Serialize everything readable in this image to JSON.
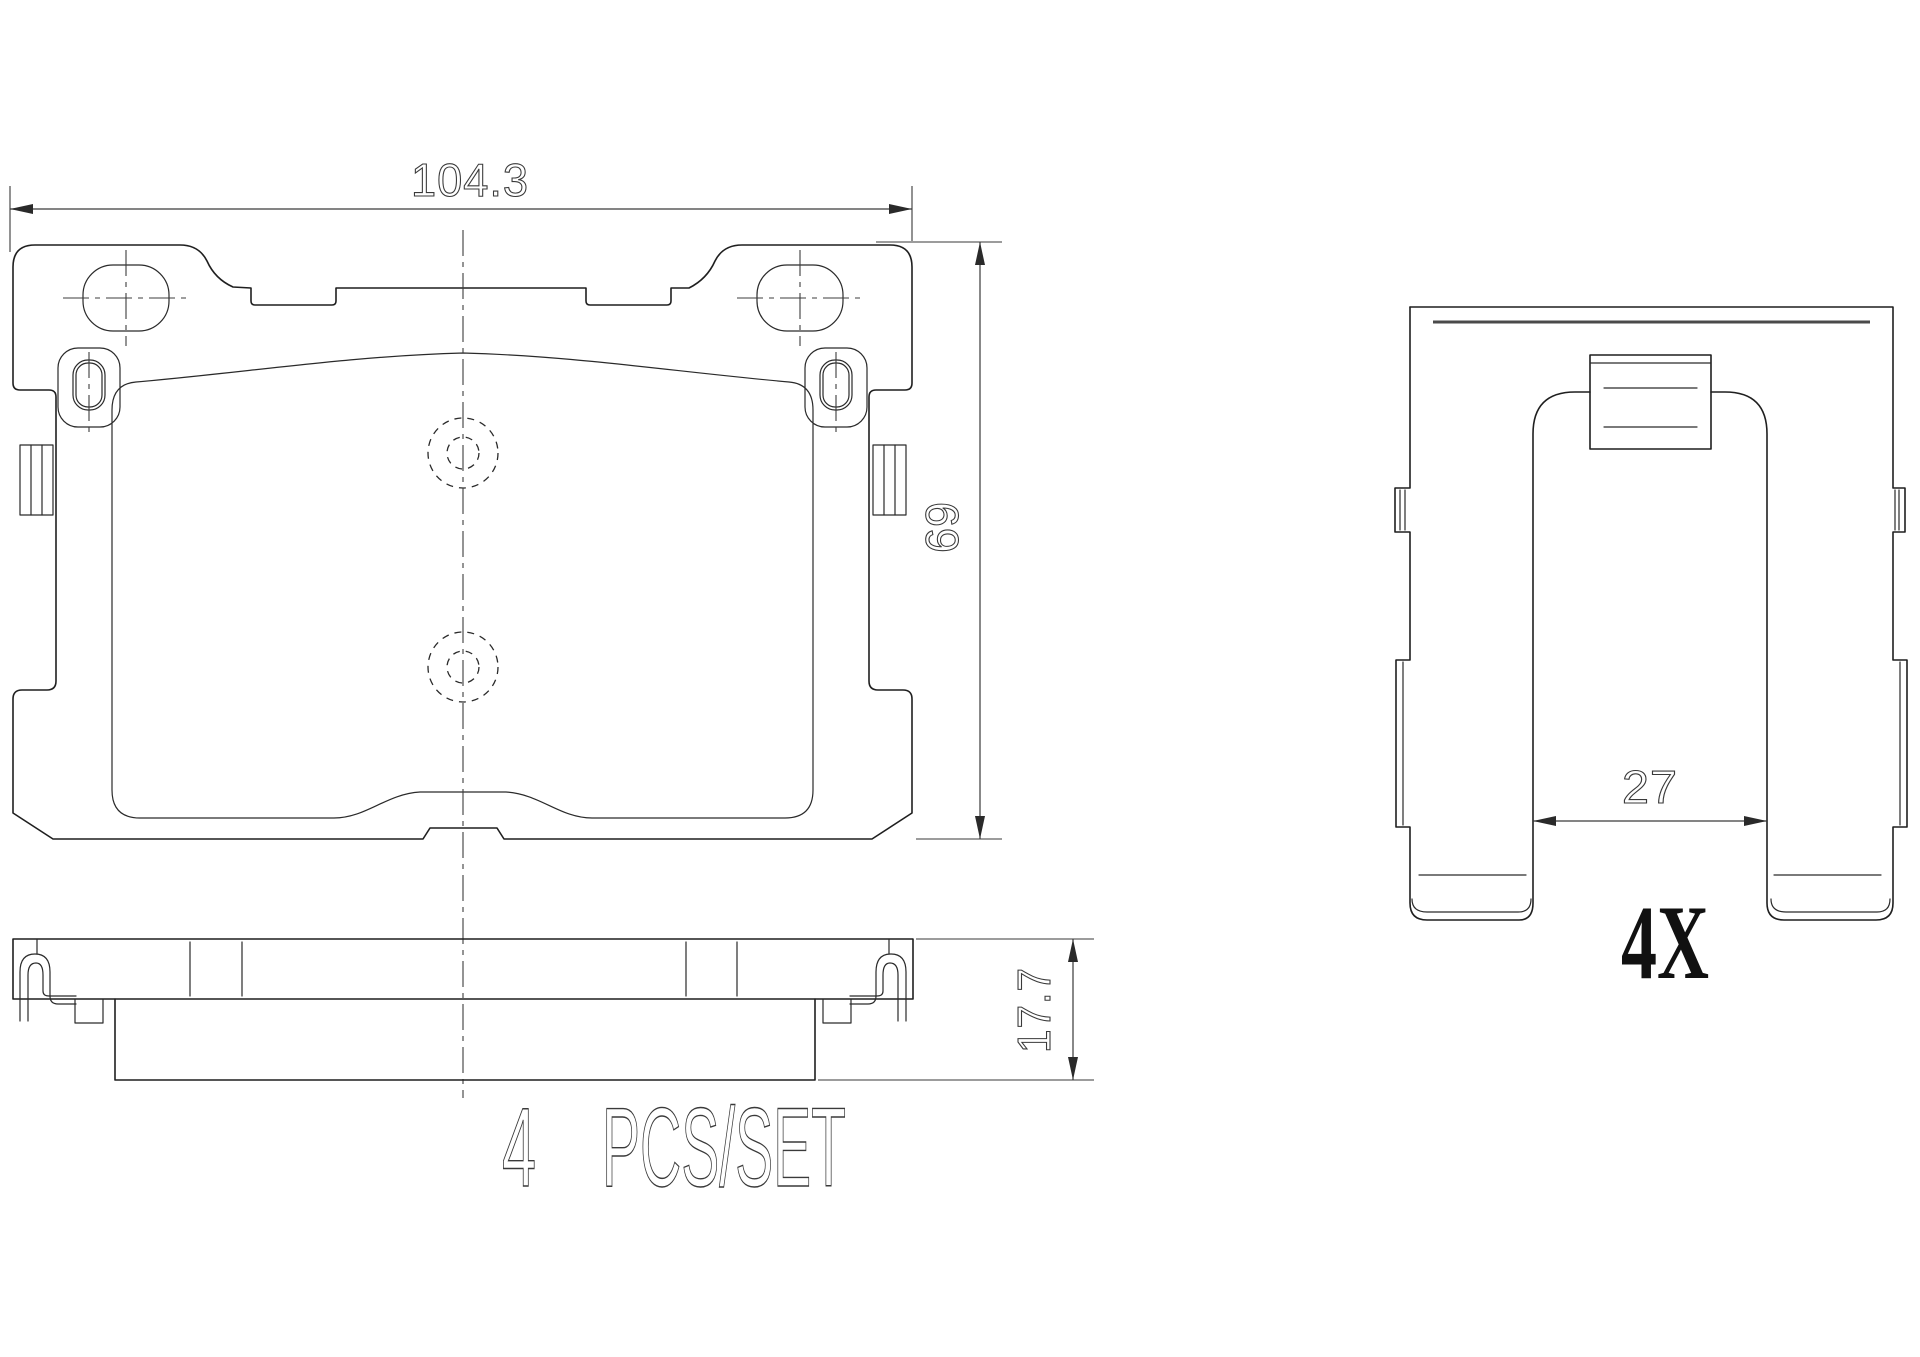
{
  "canvas": {
    "background": "#ffffff",
    "line_color": "#1f1f1f",
    "dim_color": "#3a3a3a"
  },
  "front_view": {
    "description": "brake pad front elevation",
    "width_mm": "104.3",
    "height_mm": "69"
  },
  "side_view": {
    "description": "brake pad side profile",
    "thickness_mm": "17.7"
  },
  "clip_view": {
    "description": "abutment clip",
    "opening_mm": "27",
    "quantity_label": "4X"
  },
  "footer": {
    "set_quantity": "4",
    "set_unit": "PCS/SET"
  }
}
